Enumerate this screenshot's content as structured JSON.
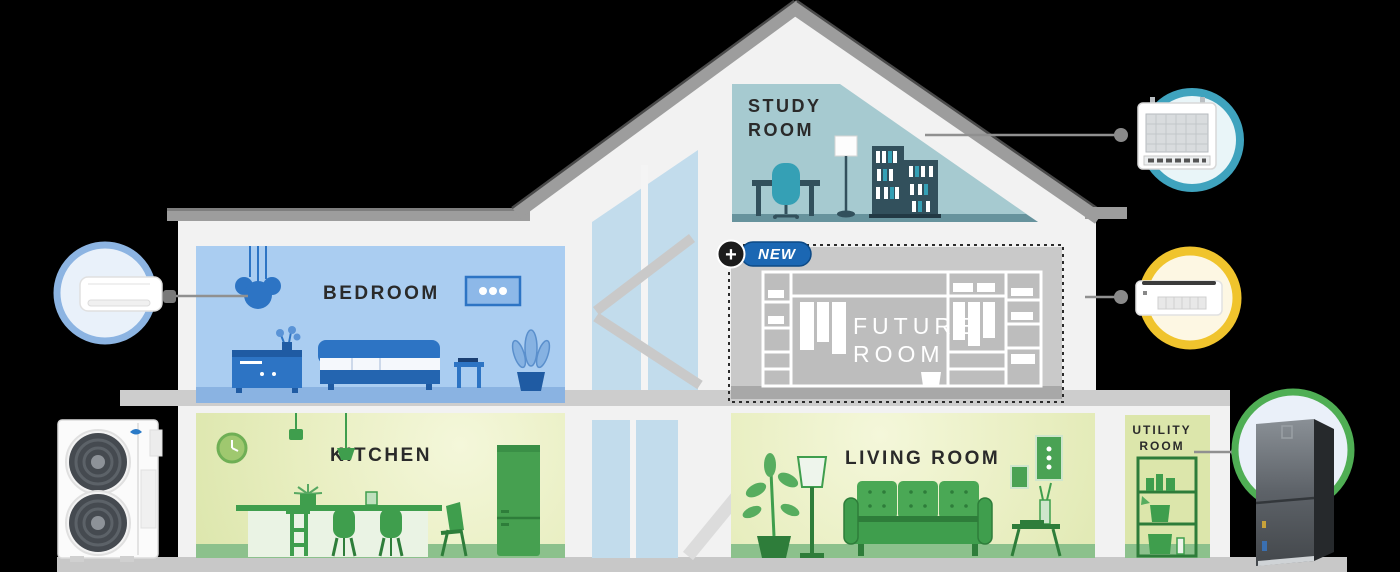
{
  "scene": {
    "name": "house cross-section with HVAC product callouts",
    "background": "#000000"
  },
  "colors": {
    "wall": "#f2f2f2",
    "roof": "#9d9d9d",
    "base_strip": "#c8c8c8",
    "bedroom_bg": "#aacdf1",
    "bedroom_floor": "#8ab3e2",
    "bedroom_accent": "#2d74c4",
    "study_bg": "#a6cad0",
    "study_floor": "#67939d",
    "study_accent": "#35a0b5",
    "green_room_bg": "#dce6ac",
    "green_room_floor": "#8cc18c",
    "green_accent": "#3f9e4d",
    "future_room_bg": "#c9c9c9",
    "ring_blue": "#8cb4e2",
    "ring_teal": "#3fa3be",
    "ring_yellow": "#f0c42d",
    "ring_green": "#4fae54",
    "badge_blue": "#1b67b3",
    "label_color": "#2a2a2a"
  },
  "rooms": {
    "study": {
      "label_line1": "STUDY",
      "label_line2": "ROOM"
    },
    "bedroom": {
      "label": "BEDROOM"
    },
    "future": {
      "label_line1": "FUTURE",
      "label_line2": "ROOM"
    },
    "kitchen": {
      "label": "KITCHEN"
    },
    "living": {
      "label": "LIVING ROOM"
    },
    "utility": {
      "label_line1": "UTILITY",
      "label_line2": "ROOM"
    }
  },
  "badge": {
    "plus": "+",
    "text": "NEW"
  },
  "callouts": {
    "ceiling_cassette": {
      "icon": "ceiling-cassette-indoor-unit-icon",
      "ring_color": "#3fa3be",
      "connects_to_room": "STUDY ROOM"
    },
    "wall_mounted": {
      "icon": "wall-mounted-indoor-unit-icon",
      "ring_color": "#8cb4e2",
      "connects_to_room": "BEDROOM"
    },
    "slim_duct": {
      "icon": "slim-duct-indoor-unit-icon",
      "ring_color": "#f0c42d",
      "connects_to_room": "FUTURE ROOM"
    },
    "air_handler": {
      "icon": "air-handler-unit-icon",
      "ring_color": "#4fae54",
      "connects_to_room": "UTILITY ROOM"
    }
  },
  "outdoor_unit": {
    "icon": "outdoor-unit-icon",
    "brand_mark": "midea-logo"
  }
}
